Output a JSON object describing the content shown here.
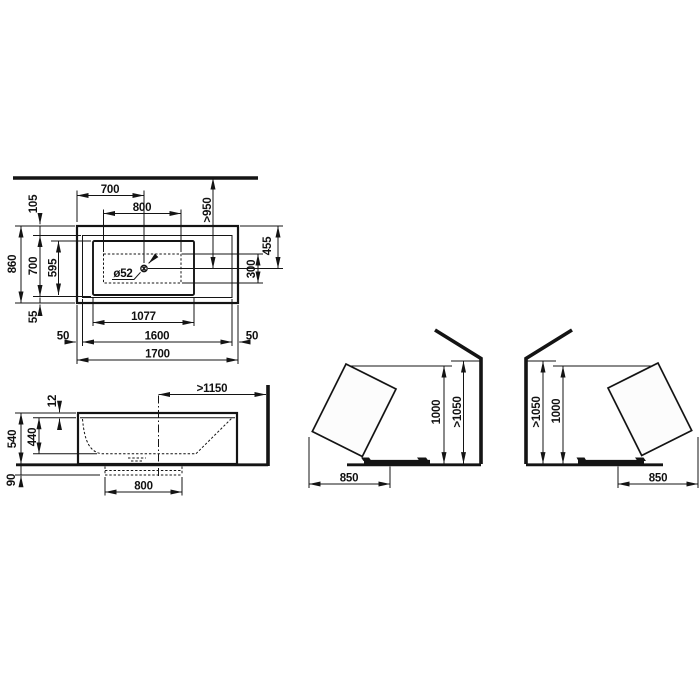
{
  "colors": {
    "line": "#141414",
    "background": "#ffffff",
    "tub_fill": "#fcfcfc"
  },
  "views": {
    "top": {
      "dims": {
        "left_edge_to_drain": "700",
        "drain_zone_length": "800",
        "wall_to_drain": ">950",
        "rim_top": "105",
        "overall_width": "860",
        "inner_width": "700",
        "basin_width": "595",
        "rim_bottom": "55",
        "top_edge_to_drain": "455",
        "drain_zone_width": "300",
        "drain_diameter": "ø52",
        "basin_length": "1077",
        "rim_left": "50",
        "inner_length": "1600",
        "rim_right": "50",
        "overall_length": "1700"
      }
    },
    "side": {
      "dims": {
        "drain_to_wall": ">1150",
        "rim_thickness": "12",
        "overall_height": "540",
        "inner_depth": "440",
        "plinth_height": "90",
        "plinth_length": "800"
      }
    },
    "tilt_left": {
      "dims": {
        "tub_height": "1000",
        "wall_clearance": ">1050",
        "floor_clearance": "850"
      }
    },
    "tilt_right": {
      "dims": {
        "wall_clearance": ">1050",
        "tub_height": "1000",
        "floor_clearance": "850"
      }
    }
  }
}
